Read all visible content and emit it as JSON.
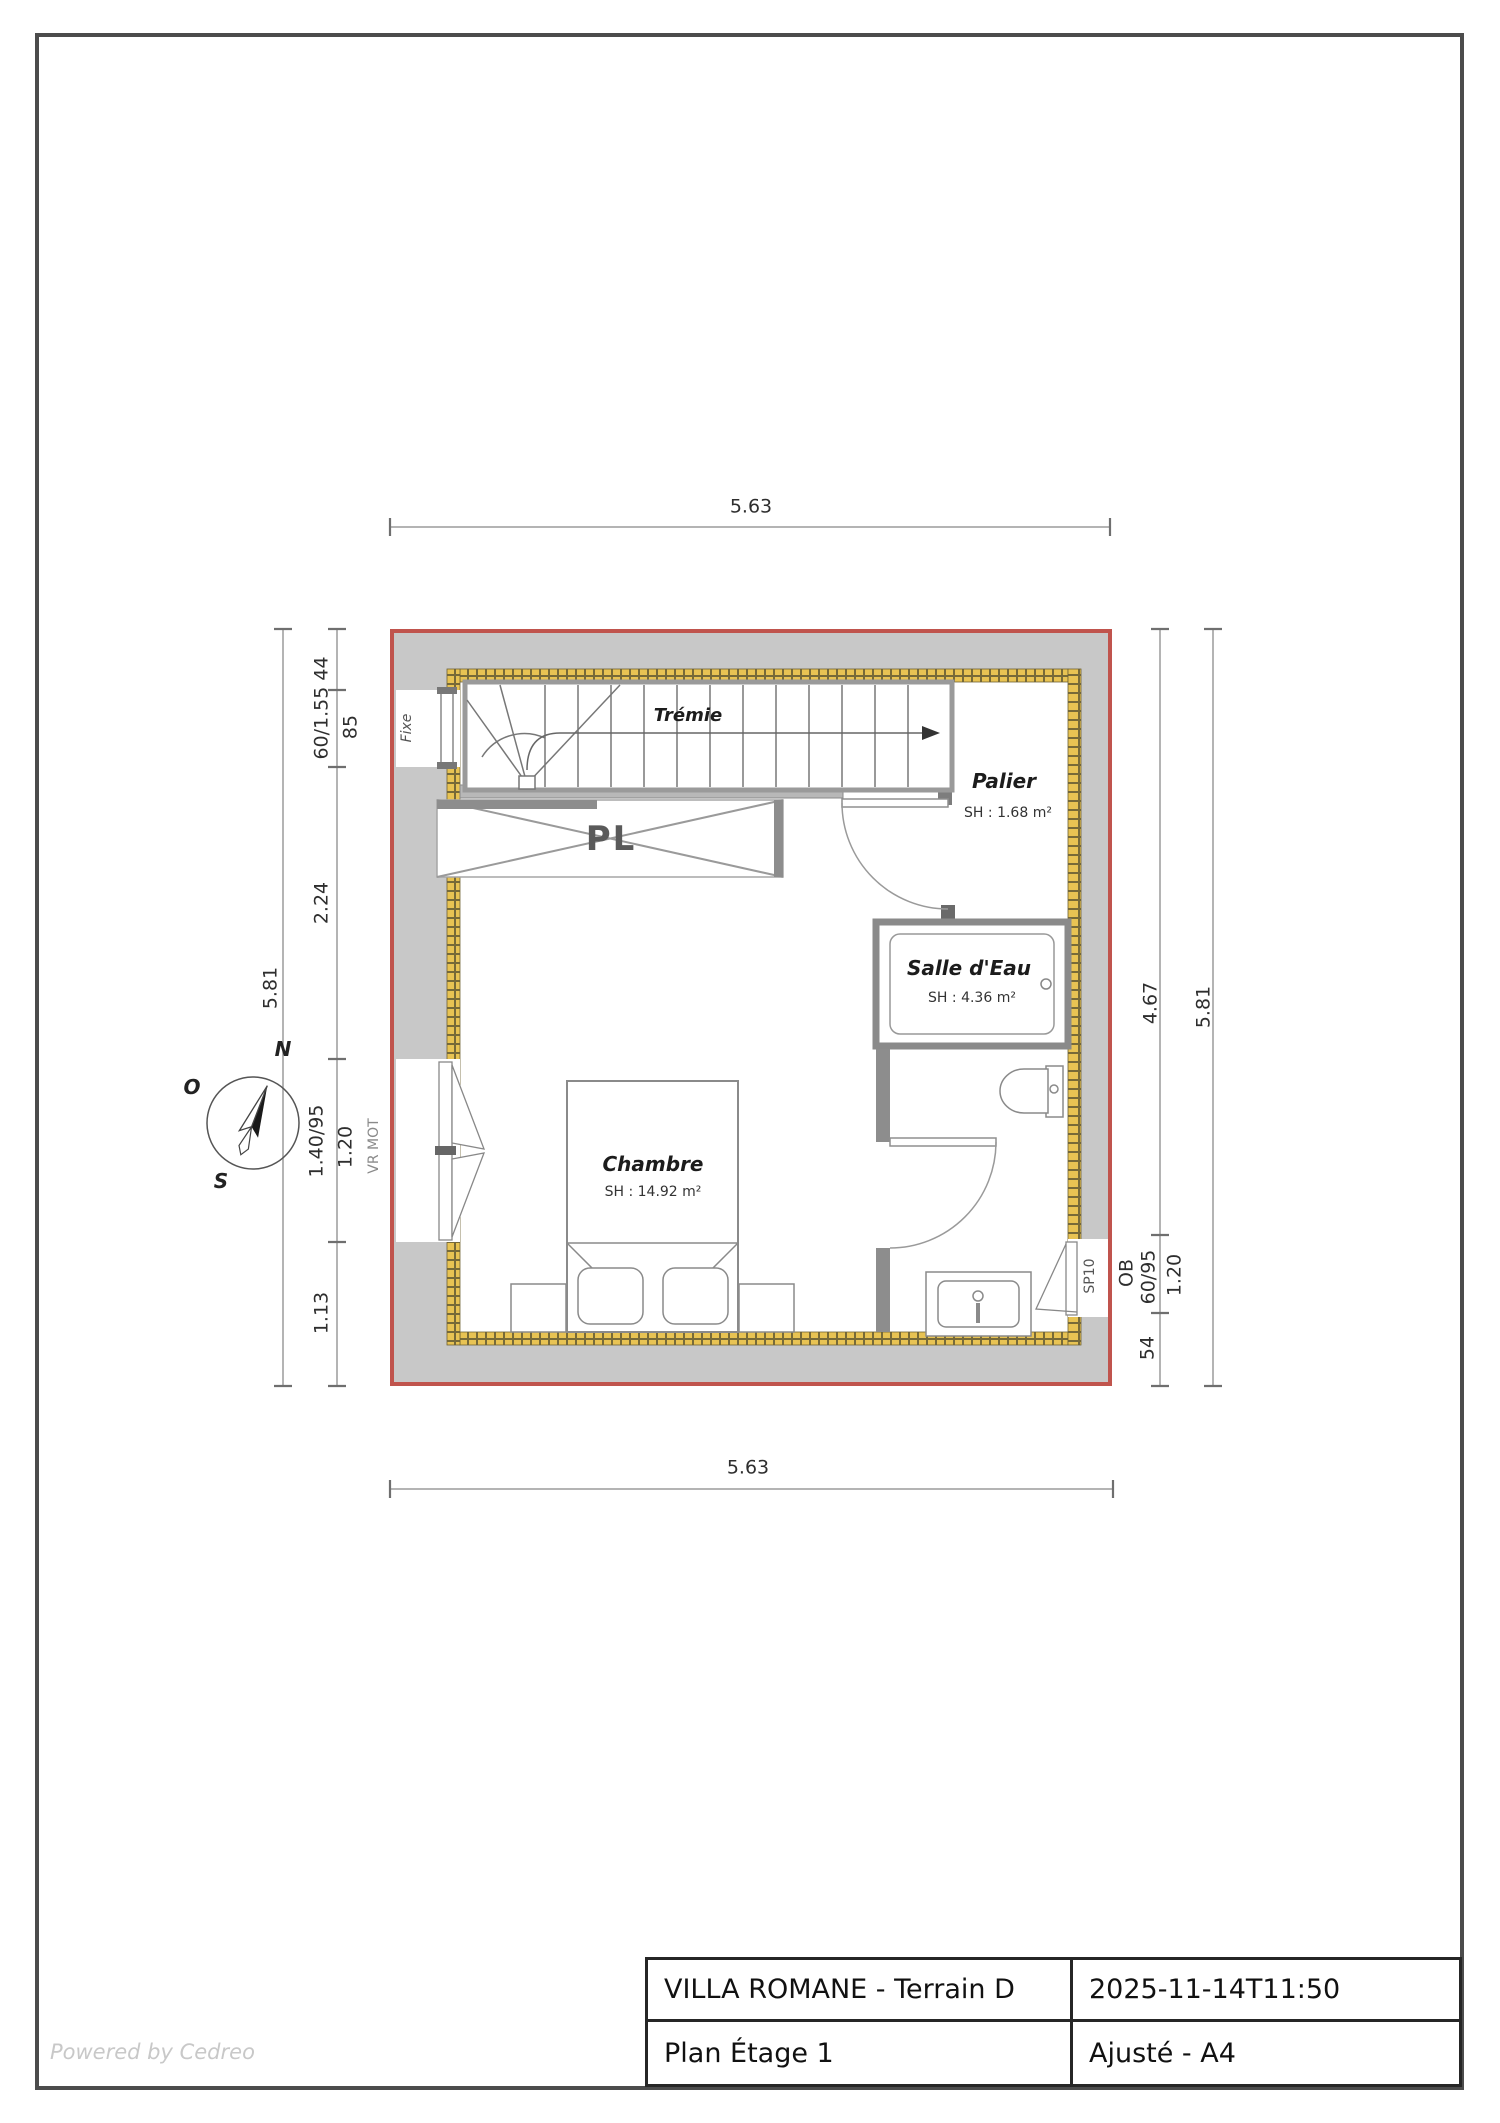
{
  "page": {
    "watermark": "Powered by Cedreo"
  },
  "title_block": {
    "project": "VILLA ROMANE - Terrain D",
    "timestamp": "2025-11-14T11:50",
    "plan_name": "Plan Étage 1",
    "format": "Ajusté - A4"
  },
  "compass": {
    "n": "N",
    "o": "O",
    "s": "S"
  },
  "rooms": {
    "tremie": "Trémie",
    "palier_name": "Palier",
    "palier_area": "SH : 1.68 m²",
    "salle_name": "Salle d'Eau",
    "salle_area": "SH : 4.36 m²",
    "chambre_name": "Chambre",
    "chambre_area": "SH : 14.92 m²",
    "placard": "PL"
  },
  "openings": {
    "fixe": "Fixe",
    "vr_mot": "VR MOT",
    "sp10": "SP10"
  },
  "dims": {
    "top": "5.63",
    "bottom": "5.63",
    "left_total": "5.81",
    "left_top_window": "60/1.55 44",
    "left_top_sill": "85",
    "left_mid": "2.24",
    "left_win": "1.40/95",
    "left_win_sill": "1.20",
    "left_bottom": "1.13",
    "right_height": "4.67",
    "right_total": "5.81",
    "right_ob": "OB",
    "right_win": "60/95",
    "right_sill": "1.20",
    "right_bottom": "54"
  },
  "colors": {
    "wall_outline": "#c0544d",
    "insulation": "#e8c353",
    "wall_fill": "#c8c8c8"
  }
}
